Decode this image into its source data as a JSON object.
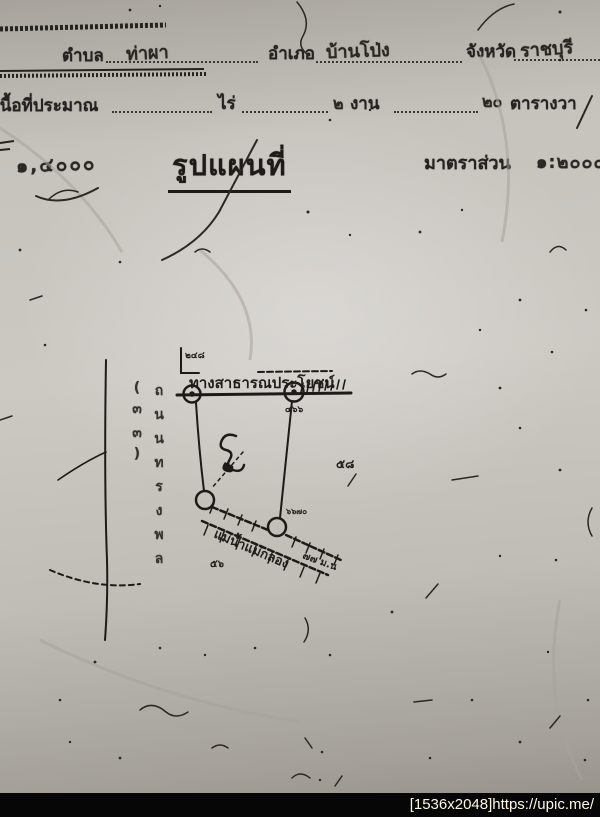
{
  "photo": {
    "header": {
      "row1": {
        "tambon_label": "ตำบล",
        "tambon_value": "ท่าผา",
        "amphoe_label": "อำเภอ",
        "amphoe_value": "บ้านโป่ง",
        "changwat_label": "จังหวัด",
        "changwat_value": "ราชบุรี"
      },
      "row2": {
        "area_label": "เนื้อที่ประมาณ",
        "rai_label": "ไร่",
        "ngan_value": "๒",
        "ngan_label": "งาน",
        "wa_value": "๒๐",
        "wa_label": "ตารางวา"
      }
    },
    "title_row": {
      "left_scale": "๑,๔๐๐๐",
      "title": "รูปแผนที่",
      "scale_label": "มาตราส่วน",
      "scale_value": "๑:๒๐๐๐"
    },
    "sketch": {
      "top_road_label": "ทางสาธารณประโยชน์",
      "note_top": "๒๔๘",
      "note_ne": "๔๖๖",
      "note_e": "๕๘",
      "note_se": "๖๖๗๐",
      "note_s": "๕๖",
      "note_sw": "๗๗ ม.น",
      "left_road_label": "ถนนทรงพล (๓๓)",
      "waterway_label": "แม่น้ำแม่กลอง"
    },
    "watermark": "[1536x2048]https://upic.me/"
  }
}
